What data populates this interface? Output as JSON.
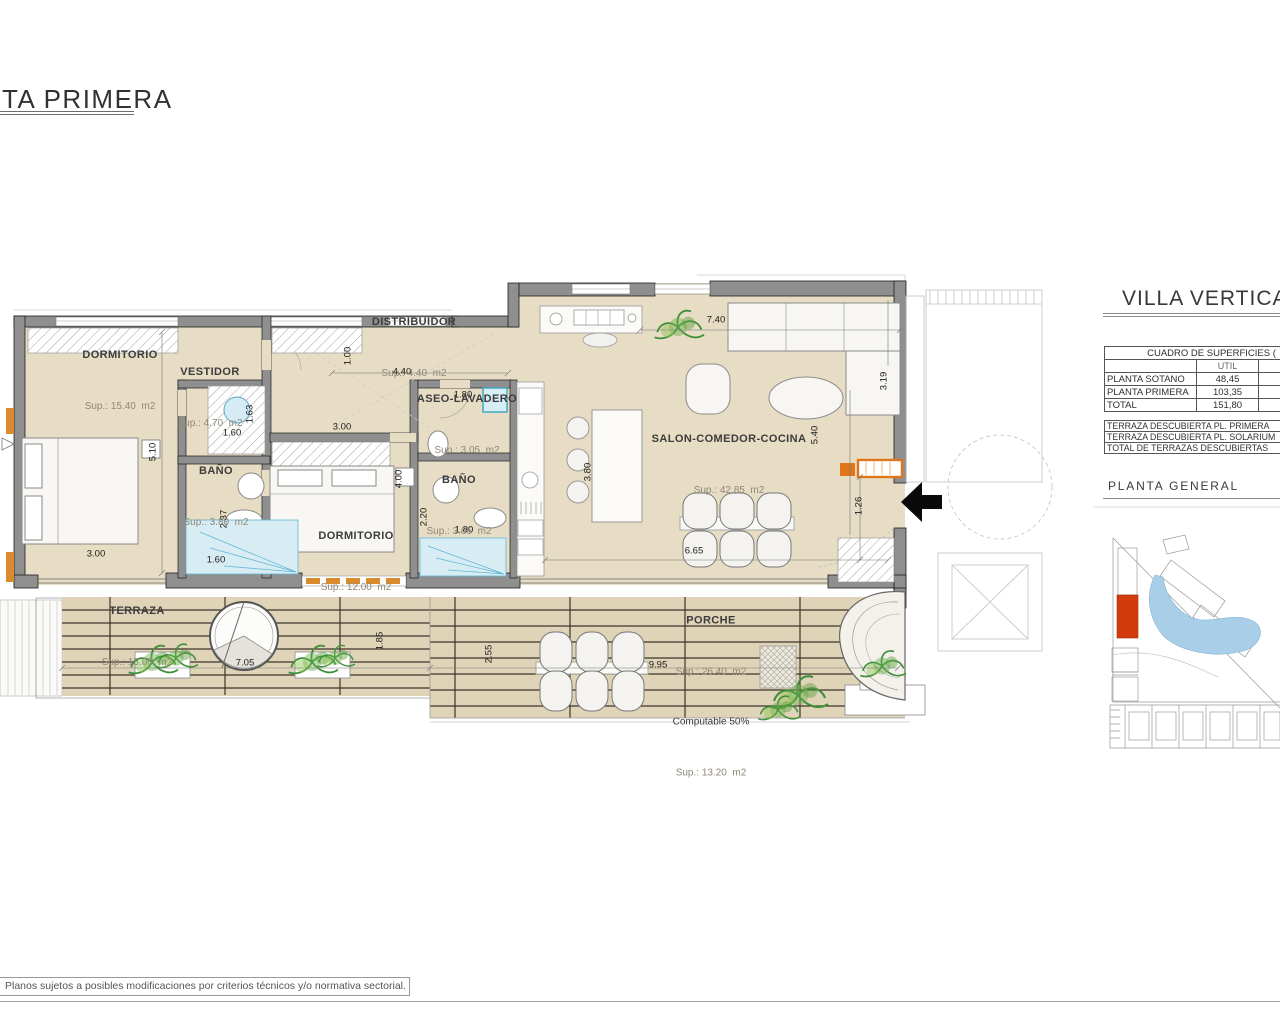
{
  "sheet": {
    "title": "TA PRIMERA",
    "disclaimer": "Planos sujetos a posibles modificaciones por criterios técnicos y/o normativa sectorial."
  },
  "panel": {
    "title": "VILLA VERTICA",
    "surfaces_table": {
      "header": "CUADRO DE SUPERFICIES (",
      "col_util": "UTIL",
      "col_cut": "C",
      "rows": [
        {
          "label": "PLANTA SOTANO",
          "util": "48,45"
        },
        {
          "label": "PLANTA PRIMERA",
          "util": "103,35"
        },
        {
          "label": "TOTAL",
          "util": "151,80"
        }
      ]
    },
    "terrace_rows": [
      "TERRAZA DESCUBIERTA PL. PRIMERA",
      "TERRAZA DESCUBIERTA PL. SOLARIUM",
      "TOTAL DE TERRAZAS DESCUBIERTAS"
    ],
    "site_plan_title": "PLANTA  GENERAL"
  },
  "plan": {
    "rooms": [
      {
        "name": "DORMITORIO",
        "sup": "Sup.: 15.40  m2"
      },
      {
        "name": "VESTIDOR",
        "sup": "Sup.: 4.70  m2"
      },
      {
        "name": "DISTRIBUIDOR",
        "sup": "Sup.: 4.40  m2"
      },
      {
        "name": "ASEO-LAVADERO",
        "sup": "Sup.: 3.05  m2"
      },
      {
        "name": "BAÑO",
        "sup": "Sup.: 3.80  m2"
      },
      {
        "name": "BAÑO",
        "sup": "Sup.: 3.95  m2"
      },
      {
        "name": "DORMITORIO",
        "sup": "Sup.: 12.00  m2"
      },
      {
        "name": "SALON-COMEDOR-COCINA",
        "sup": "Sup.: 42.85  m2"
      },
      {
        "name": "TERRAZA",
        "sup": "Sup.: 13.00  m2"
      },
      {
        "name": "PORCHE",
        "sup": "Sup.: 26.40  m2",
        "note": "Computable 50%",
        "sup2": "Sup.: 13.20  m2"
      }
    ],
    "dims": [
      "5.10",
      "3.00",
      "1.60",
      "2.37",
      "1.63",
      "1.60",
      "1.00",
      "4.40",
      "3.00",
      "4.00",
      "2.20",
      "1.80",
      "1.80",
      "3.80",
      "7.40",
      "3.19",
      "5.40",
      "1.26",
      "6.65",
      "7.05",
      "1.85",
      "2.55",
      "9.95"
    ]
  },
  "colors": {
    "floor": "#e7dcc4",
    "deck": "#e0d4b8",
    "wall": "#8f8f8f",
    "accent_orange": "#e0761c",
    "site_highlight": "#d23c0c",
    "pool": "#a9cfe8",
    "plant": "#3f8f3a",
    "shower": "#d8ecf4"
  }
}
